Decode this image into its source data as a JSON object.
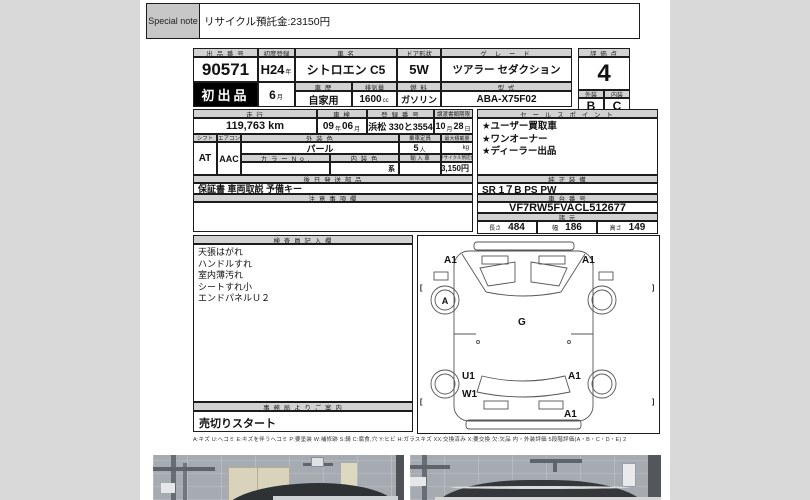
{
  "note": {
    "label": "Special note",
    "text": "リサイクル預託金:23150円"
  },
  "labels": {
    "lot": "出 品 番 号",
    "first_reg": "初度登録",
    "name": "車  名",
    "door": "ドア形状",
    "grade": "グ レ ー ド",
    "score": "評 価 点",
    "hist": "車 歴",
    "disp": "排気量",
    "fuel": "燃 料",
    "model": "型 式",
    "ext": "外装",
    "int": "内装",
    "mile": "走 行",
    "insp": "車 検",
    "regno": "登 録 番 号",
    "deadline": "譲渡書類期限",
    "sales": "セ ー ル ス ポ イ ン ト",
    "shift": "シフト",
    "ac": "エアコン",
    "extcolor": "外 装 色",
    "cap": "乗車定員",
    "load": "最大積載量",
    "colorno": "カ ラ ー N o .",
    "intcolor": "内 装 色",
    "import": "輸 入 車",
    "recycle": "リサイクル預託金",
    "parts": "後 日 発 送 部 品",
    "equip": "純 正 装 備",
    "caution": "注 意 事 項 欄",
    "chassis": "車 台 番 号",
    "spec": "諸 元",
    "len": "長さ",
    "wid": "幅",
    "hei": "高さ",
    "inspector": "検 査 員 記 入 欄",
    "office": "事 務 局 よ り ご 案 内"
  },
  "values": {
    "lot": "90571",
    "badge": "初出品",
    "reg_year": "H24",
    "reg_month": "6",
    "name": "シトロエン C5",
    "door": "5W",
    "grade": "ツアラー セダクション",
    "score": "4",
    "ext": "B",
    "int": "C",
    "hist": "自家用",
    "disp": "1600",
    "fuel": "ガソリン",
    "model": "ABA-X75F02",
    "mile": "119,763 km",
    "insp_y": "09",
    "insp_m": "06",
    "regno": "浜松 330と3554",
    "deadline_m": "10",
    "deadline_d": "28",
    "shift": "AT",
    "ac": "AAC",
    "extcolor": "パール",
    "cap": "5",
    "intcolor": "系",
    "recycle": "23,150円",
    "parts": "保証書 車両取説 予備キー",
    "equip": "SR 1７B PS PW",
    "chassis": "VF7RW5FVACL512677",
    "len": "484",
    "wid": "186",
    "hei": "149",
    "office": "売切りスタート"
  },
  "units": {
    "yr": "年",
    "mo": "月",
    "day": "日",
    "cc": "cc",
    "pax": "人",
    "kg": "kg"
  },
  "sales_points": [
    "★ユーザー買取車",
    "★ワンオーナー",
    "★ディーラー出品"
  ],
  "inspector_notes": [
    "天張はがれ",
    "ハンドルすれ",
    "室内薄汚れ",
    "シートすれ小",
    "エンドパネルＵ２"
  ],
  "diagram": {
    "front_left": "A1",
    "front_right": "A1",
    "front_wheel": "A",
    "glass": "G",
    "rear_left_upper": "U1",
    "rear_left_lower": "W1",
    "rear_right": "A1",
    "rear_bumper": "A1"
  },
  "legend": "A:キズ U:ヘコミ E:キズを伴うヘコミ P:要塗装 W:補修跡 S:錆 C:腐食,穴 Y:ヒビ H:ガラスキズ XX:交換済み X:要交換 欠:欠品 内・外装評価 5段階評価(A・B・C・D・E) 2"
}
